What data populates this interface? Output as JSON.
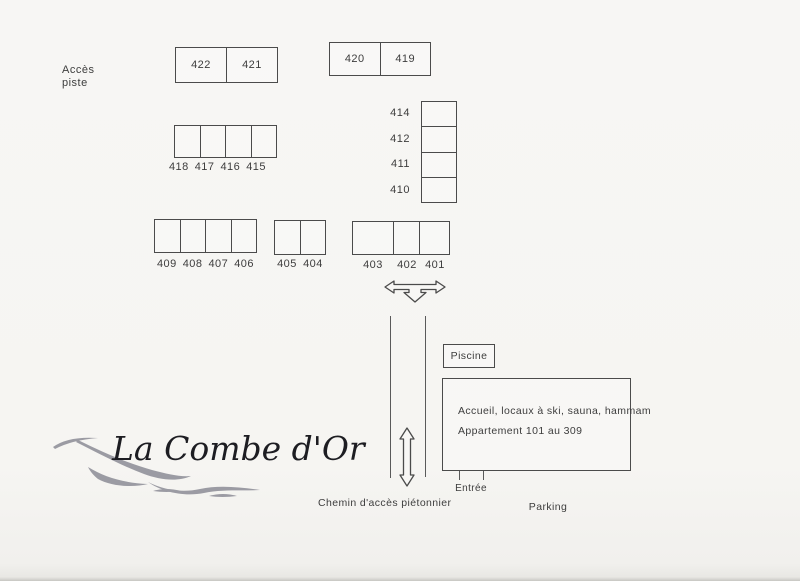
{
  "colors": {
    "background": "#f6f5f2",
    "line": "#4b4b4b",
    "text": "#3d3d3d",
    "logo_text": "#1d1d22",
    "logo_wave": "#9b9ba3"
  },
  "access": {
    "line1": "Accès",
    "line2": "piste"
  },
  "blocks": {
    "b422": {
      "cells": [
        "422",
        "421"
      ]
    },
    "b420": {
      "cells": [
        "420",
        "419"
      ]
    },
    "b414": {
      "cells": [
        "414",
        "412",
        "411",
        "410"
      ]
    },
    "b418": {
      "cells": [
        "418",
        "417",
        "416",
        "415"
      ]
    },
    "b409": {
      "cells": [
        "409",
        "408",
        "407",
        "406"
      ]
    },
    "b405": {
      "cells": [
        "405",
        "404"
      ]
    },
    "b403": {
      "cells": [
        "403",
        "402",
        "401"
      ]
    }
  },
  "facilities": {
    "piscine": "Piscine",
    "accueil_line1": "Accueil, locaux à ski, sauna, hammam",
    "accueil_line2": "Appartement 101 au 309",
    "entree": "Entrée",
    "parking": "Parking",
    "chemin_pieton": "Chemin d'accès piétonnier"
  },
  "logo": {
    "title": "La Combe d'Or"
  }
}
